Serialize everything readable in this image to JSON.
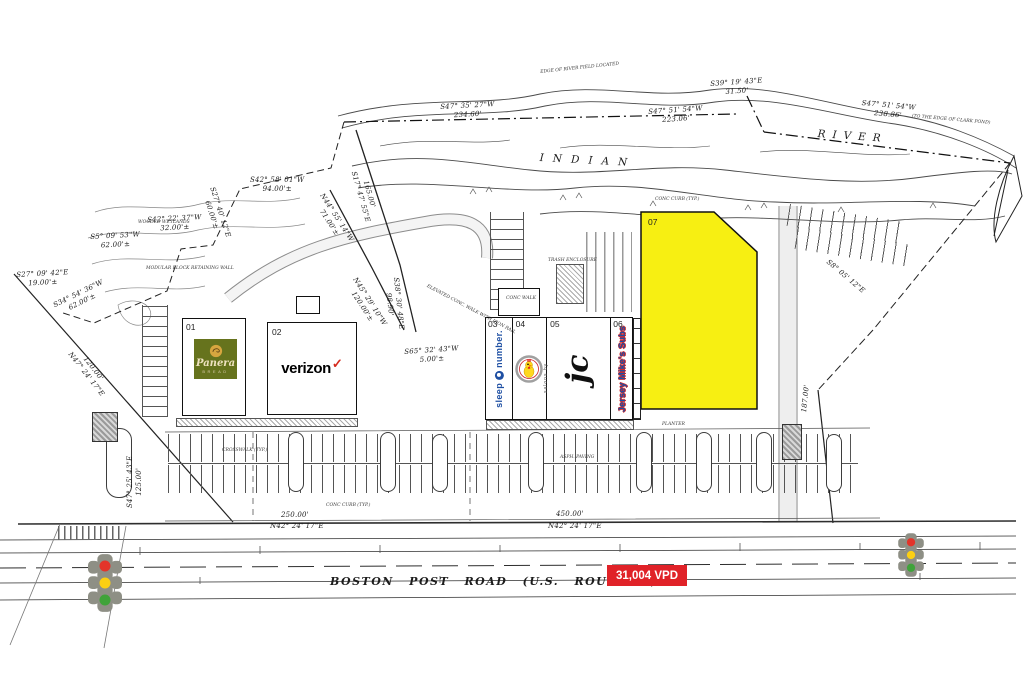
{
  "river": {
    "indian": "INDIAN",
    "river": "RIVER"
  },
  "road": {
    "name": "BOSTON POST ROAD (U.S. ROUTE 1)",
    "traffic_count": "31,004 VPD"
  },
  "units": {
    "u1": {
      "num": "01",
      "logo_script": "Panera",
      "logo_sub": "BREAD"
    },
    "u2": {
      "num": "02",
      "logo": "verizon",
      "check": "✓"
    },
    "u3": {
      "num": "03",
      "word1": "sleep",
      "word2": "number."
    },
    "u4": {
      "num": "04"
    },
    "u5": {
      "num": "05",
      "logo": "jc",
      "sub": "salons by"
    },
    "u6": {
      "num": "06",
      "label": "Jersey Mike's Subs"
    },
    "u7": {
      "num": "07"
    }
  },
  "bearings": [
    {
      "t": "S47° 35' 27\"W\n234.60'"
    },
    {
      "t": "S47° 51' 54\"W\n223.06'"
    },
    {
      "t": "S47° 51' 54\"W\n238.86'"
    },
    {
      "t": "S39° 19' 43\"E\n31.50'"
    },
    {
      "t": "S42° 58' 01\"W\n94.00'±"
    },
    {
      "t": "S27° 40' 12\"E\n60.00'±"
    },
    {
      "t": "S42° 22' 37\"W\n32.00'±"
    },
    {
      "t": "S5° 09' 53\"W\n62.00'±"
    },
    {
      "t": "S27° 09' 42\"E\n19.00'±"
    },
    {
      "t": "S34° 54' 36\"W\n62.00'±"
    },
    {
      "t": "N44° 55' 14\"W\n71.00'±"
    },
    {
      "t": "165.00'\nS17° 47' 55\"E"
    },
    {
      "t": "N45° 29' 10\"W\n120.00'±"
    },
    {
      "t": "S38° 30' 48\"E\n98.90'"
    },
    {
      "t": "S65° 32' 43\"W\n5.00'±"
    },
    {
      "t": "120.00'\nN47° 24' 17\"E"
    },
    {
      "t": "S47° 25' 43\"E\n125.00'"
    },
    {
      "t": "250.00'"
    },
    {
      "t": "N42° 24' 17\"E"
    },
    {
      "t": "450.00'"
    },
    {
      "t": "N42° 24' 17\"E"
    },
    {
      "t": "S8° 05' 12\"E"
    },
    {
      "t": "187.00'"
    }
  ],
  "micro": [
    {
      "t": "(TO THE EDGE OF CLARK POND)"
    },
    {
      "t": "EDGE OF RIVER FIELD LOCATED"
    },
    {
      "t": "ELEVATED CONC. WALK WITH IRON RAIL"
    },
    {
      "t": "MODULAR BLOCK RETAINING WALL"
    },
    {
      "t": "CONC CURB (TYP.)"
    },
    {
      "t": "CONC WALK"
    },
    {
      "t": "TRASH ENCLOSURE"
    },
    {
      "t": "CROSSWALK (TYP.)"
    },
    {
      "t": "WOODED WETLANDS"
    },
    {
      "t": "PLANTER"
    },
    {
      "t": "ASPH. PAVING"
    },
    {
      "t": "CONC CURB (TYP.)"
    }
  ],
  "icons": {
    "verizon_check": "checkmark-icon",
    "sleep_number_badge": "circle-badge-icon",
    "u4_logo": "chicken-mascot-icon",
    "panera_logo": "mother-bread-icon",
    "traffic_signal": "traffic-light-icon"
  },
  "colors": {
    "parcel_highlight": "#f7ef12",
    "traffic_badge_bg": "#e02228",
    "verizon_check": "#d52b1e",
    "panera_box": "#66731d",
    "sleep_number_blue": "#1e4fa3",
    "jersey_mikes_blue": "#1c4fa3",
    "jersey_mikes_outline": "#d62a2a",
    "signal_red": "#e3342a",
    "signal_yellow": "#fccf12",
    "signal_green": "#3fa33a"
  }
}
